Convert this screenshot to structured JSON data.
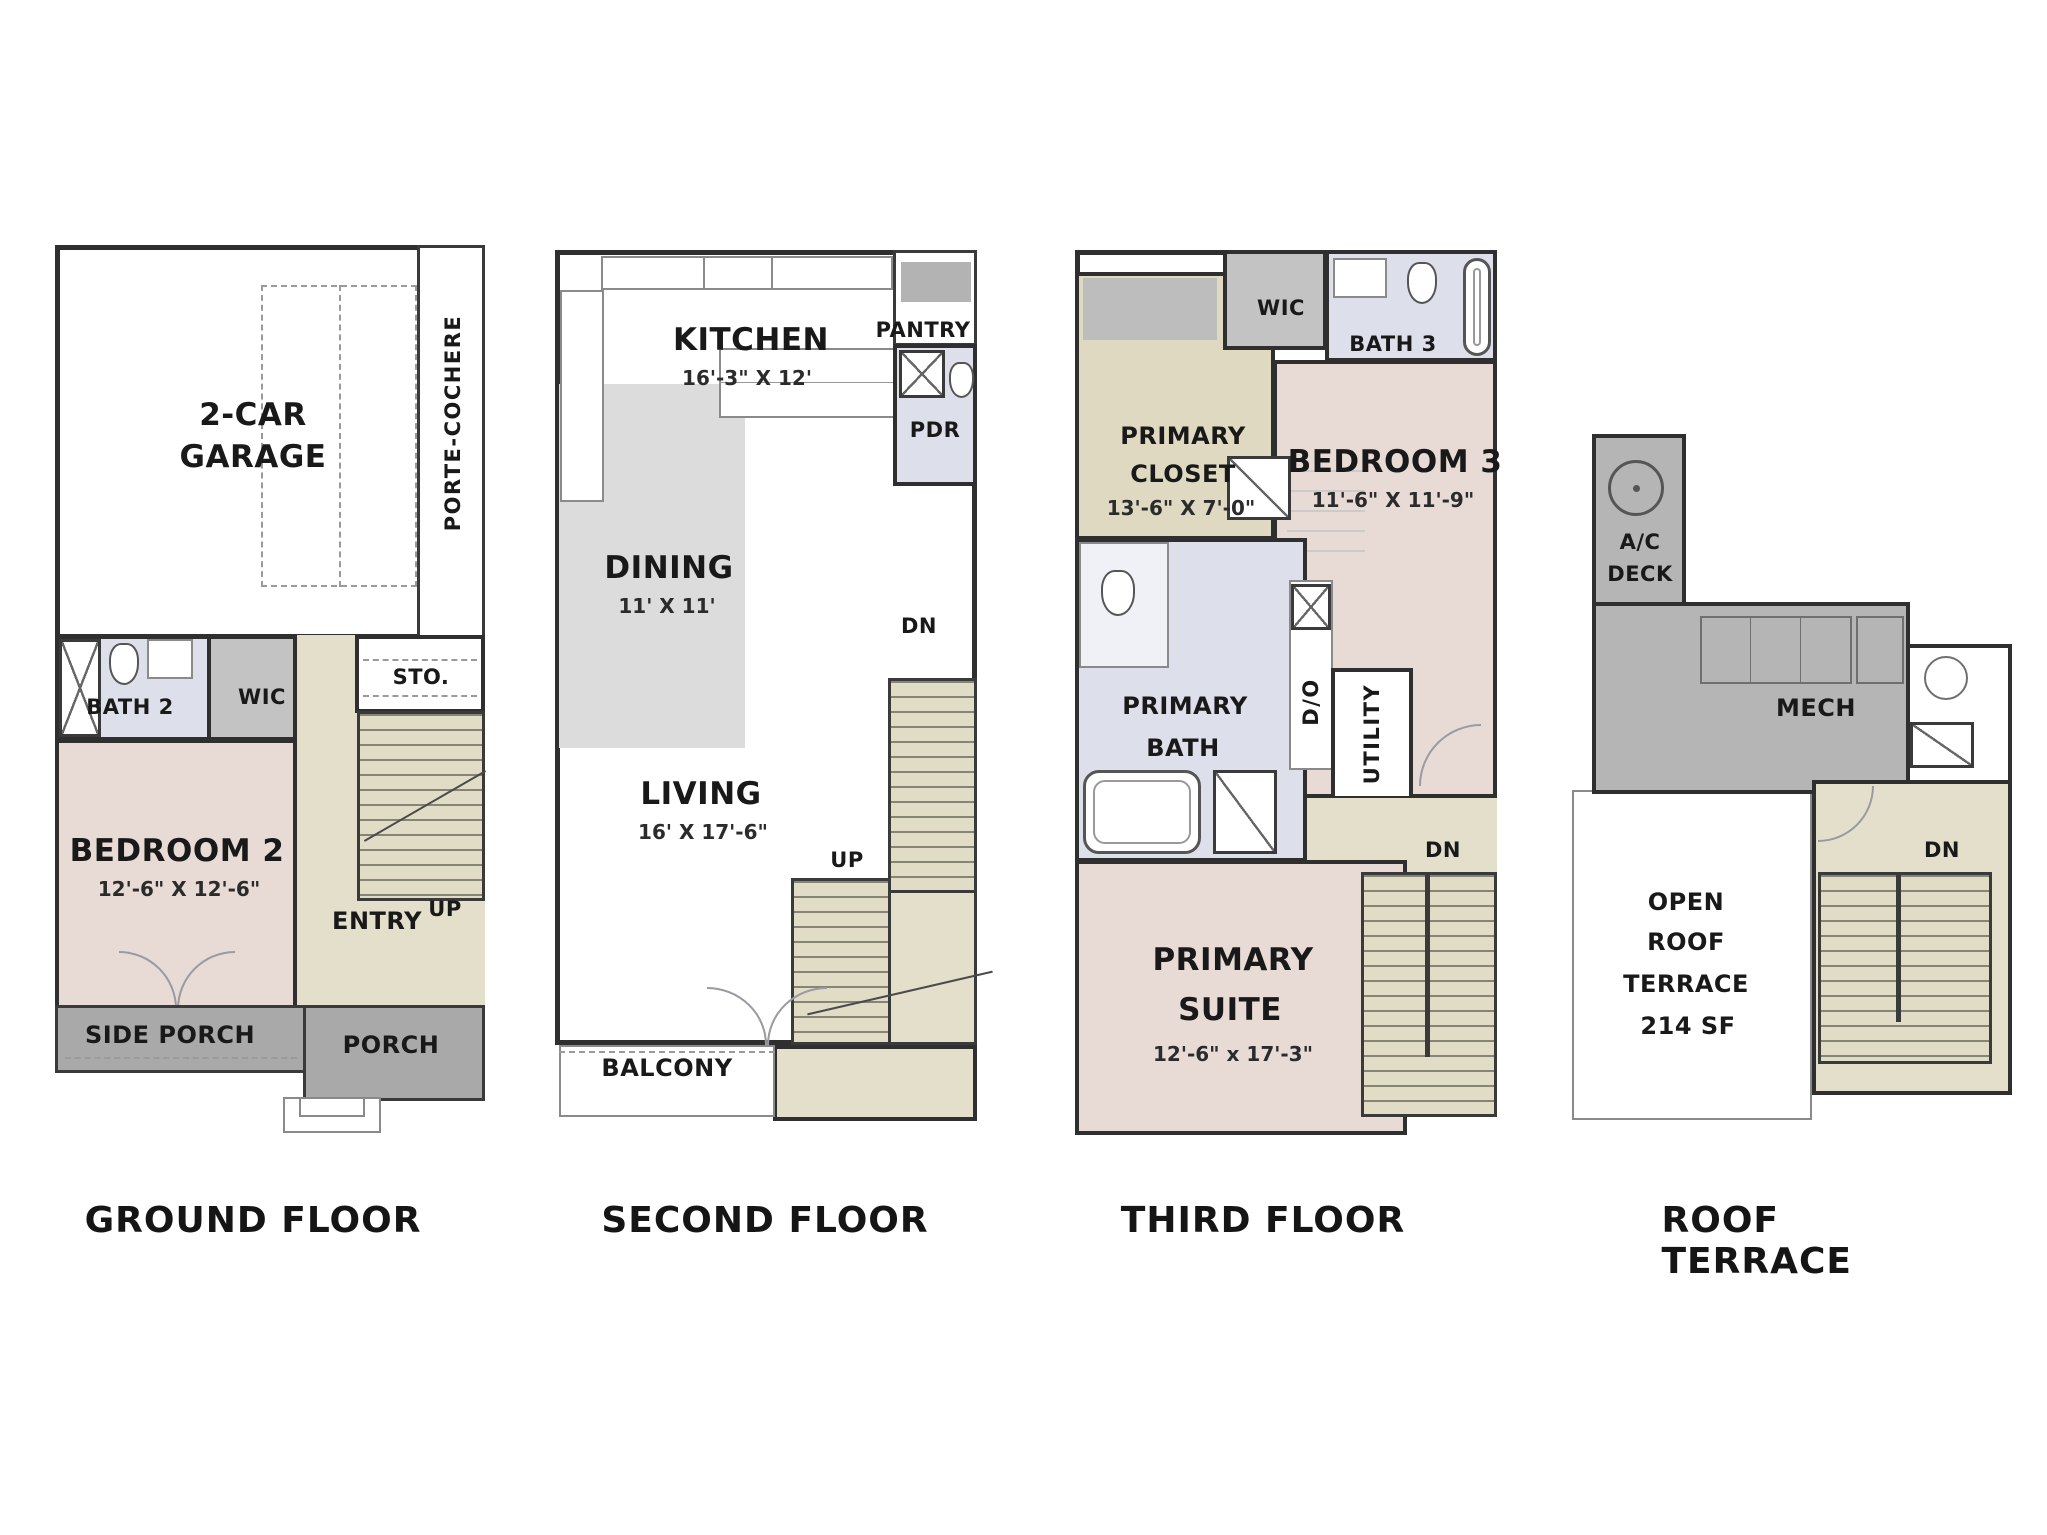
{
  "palette": {
    "wall": "#2f2f2f",
    "bedroom_pink": "#e8dbd5",
    "entry_beige": "#e4dfcb",
    "stair_beige": "#e1dcc5",
    "porch_gray": "#a9a9a9",
    "closet_gray": "#c3c3c3",
    "mech_gray": "#b5b5b5",
    "dining_gray": "#dcdcdc",
    "bath_lavender": "#dde0ea",
    "closet_khaki": "#ded9c0",
    "white": "#ffffff"
  },
  "titles": {
    "ground": "GROUND FLOOR",
    "second": "SECOND FLOOR",
    "third": "THIRD FLOOR",
    "roof": "ROOF TERRACE"
  },
  "ground": {
    "garage_l1": "2-CAR",
    "garage_l2": "GARAGE",
    "porte_cochere": "PORTE-COCHERE",
    "bath2": "BATH 2",
    "wic": "WIC",
    "sto": "STO.",
    "bedroom2": "BEDROOM 2",
    "bedroom2_dim": "12'-6\" X 12'-6\"",
    "entry": "ENTRY",
    "up": "UP",
    "side_porch": "SIDE PORCH",
    "porch": "PORCH"
  },
  "second": {
    "kitchen": "KITCHEN",
    "kitchen_dim": "16'-3\" X 12'",
    "pantry": "PANTRY",
    "pdr": "PDR",
    "dining": "DINING",
    "dining_dim": "11' X 11'",
    "living": "LIVING",
    "living_dim": "16' X 17'-6\"",
    "dn": "DN",
    "up": "UP",
    "balcony": "BALCONY"
  },
  "third": {
    "wic": "WIC",
    "bath3": "BATH 3",
    "primary_closet_l1": "PRIMARY",
    "primary_closet_l2": "CLOSET",
    "primary_closet_dim": "13'-6\" X 7'-0\"",
    "bedroom3": "BEDROOM 3",
    "bedroom3_dim": "11'-6\" X 11'-9\"",
    "primary_bath_l1": "PRIMARY",
    "primary_bath_l2": "BATH",
    "utility": "UTILITY",
    "laundry": "D/O",
    "dn": "DN",
    "primary_suite_l1": "PRIMARY",
    "primary_suite_l2": "SUITE",
    "primary_suite_dim": "12'-6\" x 17'-3\""
  },
  "roof": {
    "ac_deck_l1": "A/C",
    "ac_deck_l2": "DECK",
    "mech": "MECH",
    "dn": "DN",
    "terrace_l1": "OPEN",
    "terrace_l2": "ROOF",
    "terrace_l3": "TERRACE",
    "terrace_l4": "214 SF"
  }
}
